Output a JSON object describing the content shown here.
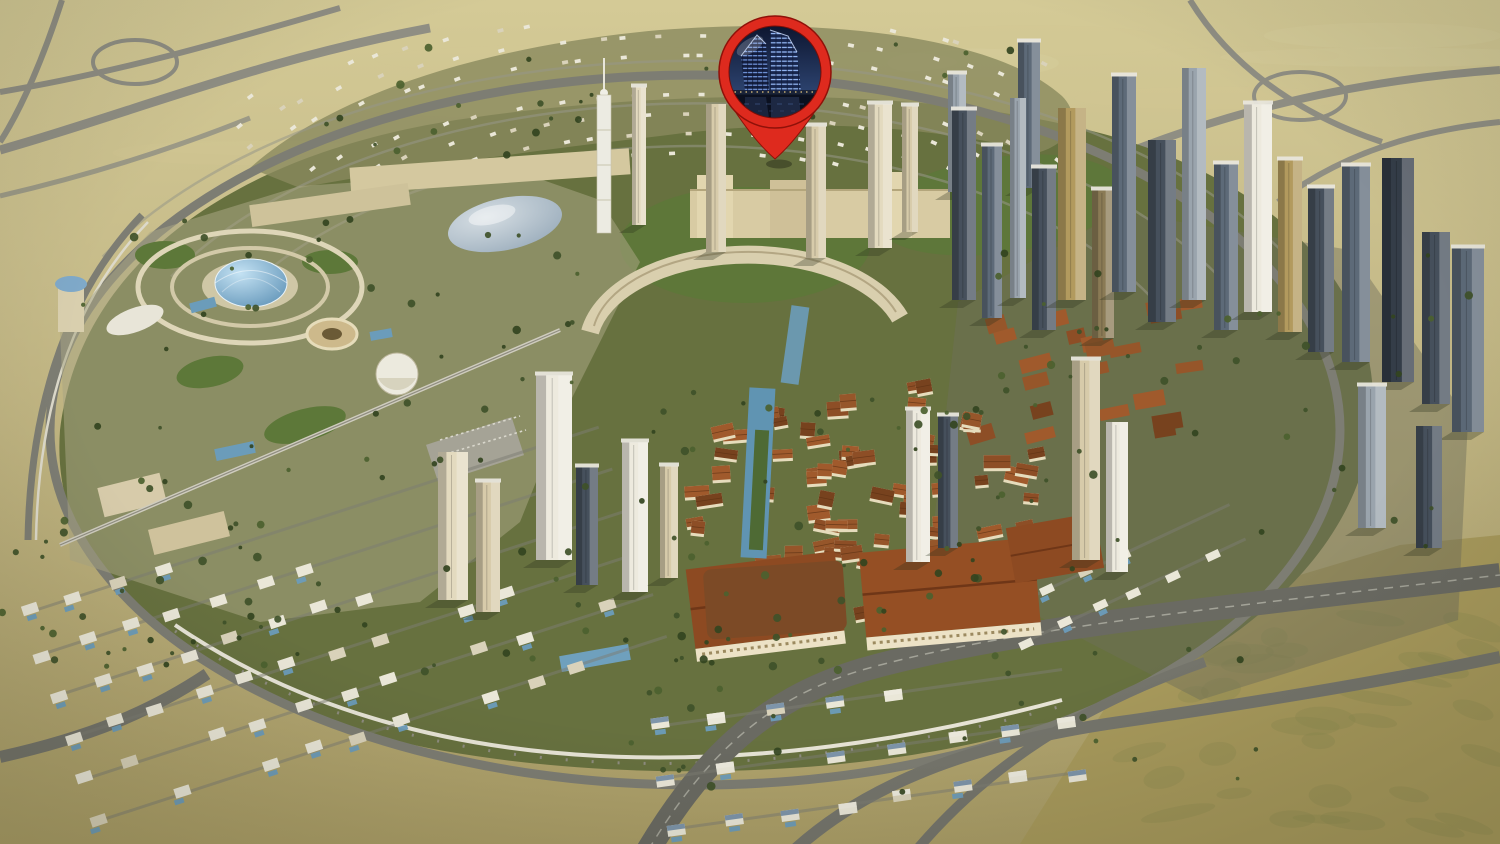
{
  "image": {
    "kind": "aerial-3d-masterplan-render",
    "alt": "Bird's-eye 3D render of a desert master-planned city district with a red location pin highlighting a waterfront twin-tower property"
  },
  "marker": {
    "name": "property-location-pin",
    "pin_color": "#de2a1e",
    "pin_dark": "#8f1109",
    "inset_sky_top": "#0d1630",
    "inset_sky_bottom": "#2e4572",
    "inset_water": "#0b101f",
    "inset_light": "#7ea6f2",
    "inset_light2": "#9cc0ff",
    "bridge_light": "#e8c87f",
    "inset_subject": "twin curved towers illuminated blue at night"
  },
  "scene": {
    "palette": {
      "desert_top": "#d2c793",
      "desert_mid": "#c4b987",
      "desert_bottom": "#b2a673",
      "field": "#a89a5c",
      "field_mottle": "#8c8a4f",
      "dev_green": "#67713f",
      "dev_green_dark": "#49552c",
      "lawn": "#5d7839",
      "road": "#7d7d73",
      "road_light": "#989889",
      "road_dark": "#66665e",
      "metro": "#e7e4d6",
      "plaza": "#b3ac8d",
      "plaza_light": "#cfc8a9",
      "villa_white": "#eae7d8",
      "villa_tan": "#d9d2ba",
      "pool": "#6b9cba",
      "roof_red": "#8d4e26",
      "roof_red2": "#a05a2c",
      "roof_dark": "#77421e",
      "wall_cream": "#e6dcbc",
      "beige": "#d7cbaa",
      "cream": "#e3dabf",
      "white": "#edeade",
      "slate": "#46505c",
      "steel": "#5d6a78",
      "silver": "#9aa4ad",
      "gold": "#b29a5e",
      "bronze": "#8a7a55",
      "darkglass": "#343d48",
      "dome_hi": "#bfe0f2",
      "dome_lo": "#4f86ad",
      "glass_hi": "#cfd8de",
      "glass_lo": "#92a4b2",
      "tree": "#3f5129",
      "tree2": "#4c612f",
      "tree3": "#33441f"
    },
    "regions": [
      "desert-horizon",
      "north-villa-fan-district",
      "theme-park-resort-west",
      "central-tower-row",
      "crescent-building",
      "old-town-village",
      "school-halls",
      "east-tower-cluster",
      "southwest-villa-district",
      "south-villa-district",
      "ring-road",
      "monorail-line",
      "south-highway",
      "southeast-desert-field"
    ]
  }
}
